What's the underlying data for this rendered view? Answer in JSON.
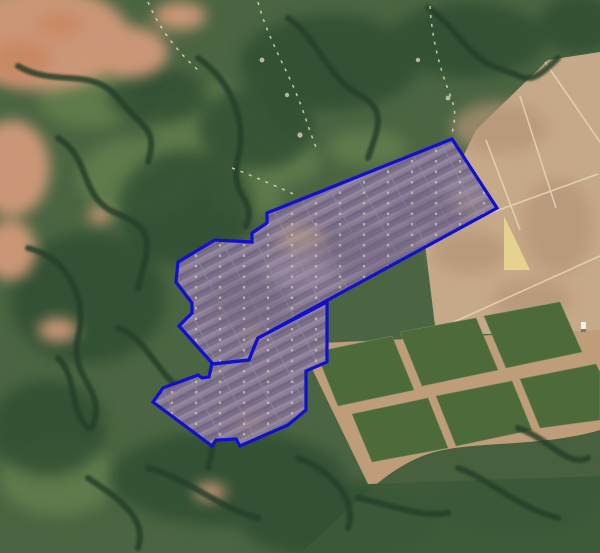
{
  "map": {
    "palette": {
      "forest_base": "#4b6542",
      "forest_dark": "#2f4e31",
      "forest_light": "#66814f",
      "field_tan": "#c6a988",
      "crop_green": "#4d6a3b",
      "bare_salmon": "#d59b7b",
      "panel_base": "#8c7e90",
      "panel_dark": "#77697f",
      "panel_dot": "#d6c7b0",
      "sand_yellow": "#e8d48e"
    },
    "overlay": {
      "boundary_color": "#1010cf",
      "fill_color": "rgba(150,140,220,0.10)",
      "stroke_width": 3.2,
      "rings": {
        "upper_band": "452,139 497,208 258,338 257,340 249,360 213,364 212,363 179,326 192,313 192,303 176,282 178,262 215,240 252,242 252,233 267,223 267,213",
        "lower_band": "212,363 213,364 249,360 257,340 258,338 327,302 327,362 306,371 306,410 288,425 240,446 236,439 216,440 212,446 153,402 163,388 198,375 202,378 209,377"
      }
    }
  }
}
